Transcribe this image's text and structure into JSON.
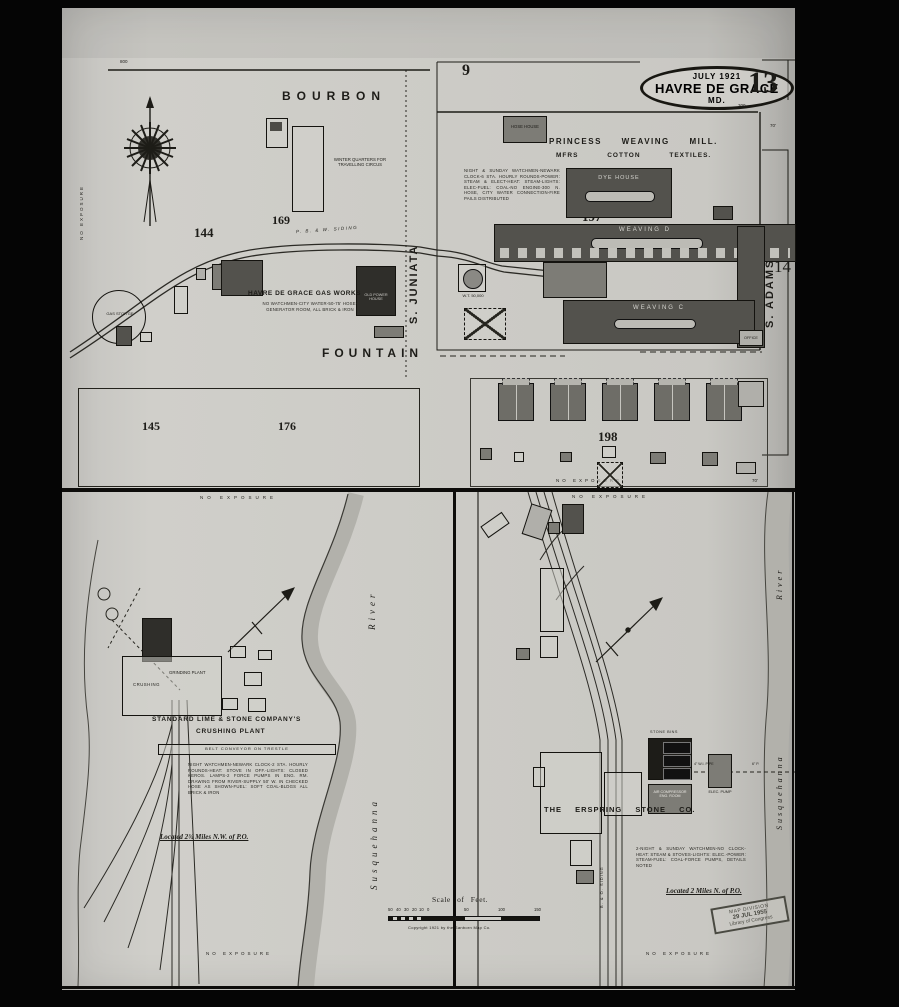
{
  "sheet": {
    "adjoining_top": "9",
    "number": "13",
    "adjoining_right": "14",
    "title_date": "JULY 1921",
    "title_city": "HAVRE DE GRACE",
    "title_state": "MD."
  },
  "streets": {
    "bourbon": "BOURBON",
    "fountain": "FOUNTAIN",
    "juniata": "S. JUNIATA",
    "adams": "S. ADAMS"
  },
  "blocks": {
    "n144": "144",
    "n169": "169",
    "n145": "145",
    "n176": "176",
    "n197": "197",
    "n198": "198"
  },
  "mill": {
    "name_line1": "PRINCESS WEAVING MILL.",
    "name_line2": "MFRS COTTON TEXTILES.",
    "note": "NIGHT & SUNDAY WATCHMEN-NEWARK CLOCK-6 STA. HOURLY ROUNDS-POWER: STEAM & ELECT-HEAT: STEAM-LIGHTS: ELEC-FUEL: COAL-NO ENGINE-300 N. HOSE, CITY WATER CONNECTION-FIRE PAILS DISTRIBUTED",
    "hose_house": "HOSE HOUSE",
    "dye_house": "DYE HOUSE",
    "weaving_d": "WEAVING D",
    "weaving_c": "WEAVING C",
    "office": "OFFICE",
    "water_tank": "W.T. 50,000"
  },
  "gas_works": {
    "name": "HAVRE DE GRACE GAS WORKS",
    "note": "NO WATCHMEN-CITY WATER-50-75' HOSE-GENERATOR ROOM, ALL BRICK & IRON",
    "old_power": "OLD POWER HOUSE",
    "holder": "GAS STOR'GE"
  },
  "circus": "WINTER QUARTERS FOR TRAVELLING CIRCUS",
  "railroads": {
    "pbw": "P. B. & W.  SIDING",
    "bo": "B. & O. SIDING"
  },
  "crushing_plant": {
    "name_line1": "STANDARD LIME & STONE COMPANY'S",
    "name_line2": "CRUSHING PLANT",
    "crushing": "CRUSHING",
    "grinding": "GRINDING PLANT",
    "conveyor": "BELT CONVEYOR ON TRESTLE",
    "note": "NIGHT WATCHMEN-NEWARK CLOCK-2 STA. HOURLY ROUNDS-HEAT: STOVE IN OFF.-LIGHTS: CLOSED KEROS. LAMPS-2 FORCE PUMPS IN ENG. RM. DRAWING FROM RIVER-SUPPLY 50' W. IN CHECKED HOSE AS SHOWN-FUEL: SOFT COAL-BLDGS ALL BRICK & IRON",
    "located": "Located 2¾ Miles N.W. of P.O."
  },
  "stone_co": {
    "name": "THE ERSPRING STONE CO.",
    "bins": "STONE BINS",
    "compressor": "AIR COMPRESSOR ENG. ROOM",
    "pump": "ELEC. PUMP",
    "pipe": "4\" W.I. PIPE",
    "pipe2": "6\" P.",
    "note": "2-NIGHT & SUNDAY WATCHMEN-NO CLOCK-HEAT: STEAM & STOVES-LIGHTS: ELEC.-POWER: STEAM-FUEL: COAL-FORCE PUMPS, DETAILS NOTED",
    "located": "Located 2 Miles N. of P.O."
  },
  "river": {
    "name1": "Susquehanna",
    "name2": "River"
  },
  "misc": {
    "no_exposure": "NO EXPOSURE"
  },
  "dims": {
    "d800": "800",
    "d300": "300",
    "d70": "70'"
  },
  "scale": {
    "title": "Scale of Feet.",
    "ticks": [
      "50",
      "40",
      "30",
      "20",
      "10",
      "0",
      "50",
      "100",
      "150"
    ],
    "copyright": "Copyright 1921 by the Sanborn Map Co."
  },
  "stamp": {
    "line1": "MAP DIVISION",
    "line2": "29 JUL 1955",
    "line3": "Library of Congress"
  }
}
